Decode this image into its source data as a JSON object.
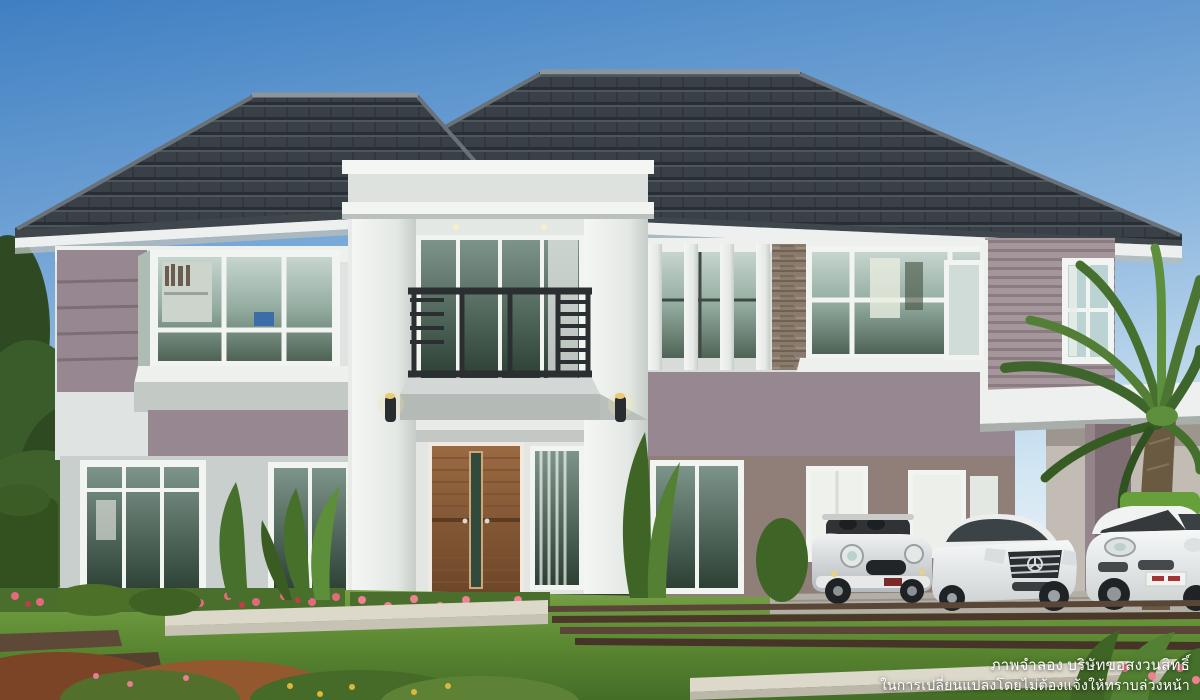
{
  "canvas": {
    "width": 1200,
    "height": 700
  },
  "scene": {
    "title": "Two-storey contemporary detached house exterior render",
    "elements": [
      "hip roof with dark grey tiles",
      "white entrance tower with balcony and dark metal railing",
      "wooden double front door",
      "mauve accent walls and lap siding",
      "stone-clad pillar",
      "carport with flat white roof",
      "silver convertible mini car",
      "white sedan car",
      "white suv car",
      "palm tree",
      "front lawn with planters, flower beds and timber deck"
    ]
  },
  "palette": {
    "sky_top": "#3f7fc2",
    "sky_mid": "#8ab5de",
    "sky_bottom": "#ecf4fa",
    "roof": "#3a4047",
    "roof_ridge": "#8d959c",
    "fascia_white": "#eef0ef",
    "wall_white": "#e8ebe8",
    "wall_gray": "#c9cfcc",
    "wall_mauve": "#968790",
    "wall_mauve_dark": "#7e6e74",
    "wall_taupe": "#8f7f78",
    "window_frame": "#f3f5f1",
    "glass_dark": "#3c5244",
    "glass_light": "#b9cbc6",
    "railing_dark": "#2c2f31",
    "door_wood_light": "#9a6a42",
    "door_wood_dark": "#6d4628",
    "stone": "#8a7b6c",
    "lawn_light": "#76a046",
    "lawn_dark": "#446d26",
    "hedge": "#33501f",
    "planter_white": "#ddd9ca",
    "deck_brown": "#5a4636",
    "flower_pink": "#e4697d",
    "car_silver": "#d3d7d8",
    "car_white": "#eef0f0",
    "palm_green": "#4c7533",
    "trunk_brown": "#6b5a42"
  },
  "disclaimer": {
    "line1": "ภาพจำลอง บริษัทขอสงวนสิทธิ์",
    "line2": "ในการเปลี่ยนแปลงโดยไม่ต้องแจ้งให้ทราบล่วงหน้า",
    "text_color": "#ffffff"
  }
}
